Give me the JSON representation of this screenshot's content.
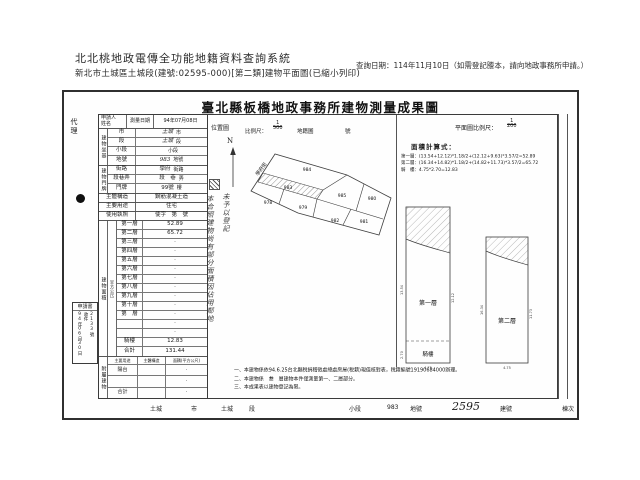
{
  "header": {
    "system_title": "北北桃地政電傳全功能地籍資料查詢系統",
    "subtitle": "新北市土城區土城段(建號:02595-000)[第二類]建物平面圖(已縮小列印)",
    "query_date": "查詢日期：114年11月10日（如需登記謄本，請向地政事務所申請。）"
  },
  "doc": {
    "title": "臺北縣板橋地政事務所建物測量成果圖",
    "agent": "代理",
    "left": {
      "applicant_l1": "申請人",
      "applicant_l2": "姓名",
      "survey_date_label": "測量日期",
      "survey_date_value": "94年07月08日",
      "site_group_label": "建物坐基",
      "site_rows": [
        {
          "label": "市",
          "value": "土城",
          "suffix": "市"
        },
        {
          "label": "段",
          "value": "土城",
          "suffix": "段"
        },
        {
          "label": "小段",
          "value": "",
          "suffix": "小段"
        },
        {
          "label": "地號",
          "value": "983",
          "suffix": "地號"
        }
      ],
      "door_group_label": "建物門牌",
      "door_rows": [
        {
          "label": "街路",
          "value": "學府",
          "suffix": "街路"
        },
        {
          "label": "段巷弄",
          "value": "段　巷",
          "suffix": "弄"
        },
        {
          "label": "門牌",
          "value": "99號",
          "suffix": "樓"
        }
      ],
      "structure_label": "主體構造",
      "structure_value": "鋼筋混凝土造",
      "usage_label": "主要用途",
      "usage_value": "住宅",
      "license_label": "使用執照",
      "license_value": "使字　第　號",
      "area_group_label": "建物面積",
      "area_unit_label": "（平方公尺）",
      "application": {
        "title": "申請書",
        "date": "94年06月30日",
        "recv": "收件",
        "no": "2133號"
      },
      "floors": [
        {
          "label": "第一層",
          "value": "52.89"
        },
        {
          "label": "第二層",
          "value": "65.72"
        },
        {
          "label": "第三層",
          "value": "·"
        },
        {
          "label": "第四層",
          "value": "·"
        },
        {
          "label": "第五層",
          "value": "·"
        },
        {
          "label": "第六層",
          "value": "·"
        },
        {
          "label": "第七層",
          "value": "·"
        },
        {
          "label": "第八層",
          "value": "·"
        },
        {
          "label": "第九層",
          "value": "·"
        },
        {
          "label": "第十層",
          "value": "·"
        },
        {
          "label": "第　層",
          "value": "·"
        },
        {
          "label": "",
          "value": "·"
        },
        {
          "label": "",
          "value": "·"
        },
        {
          "label": "騎樓",
          "value": "12.83"
        },
        {
          "label": "合計",
          "value": "131.44"
        }
      ],
      "annex_group_label": "附屬建物",
      "annex_header": {
        "usage": "主要用途",
        "structure": "主體構造",
        "area": "面積(平方公尺)"
      },
      "annex_rows": [
        {
          "usage": "陽台",
          "structure": "",
          "area": "·"
        },
        {
          "usage": "",
          "structure": "",
          "area": "·"
        },
        {
          "usage": "合計",
          "structure": "",
          "area": "·"
        }
      ]
    },
    "middle": {
      "location_label": "位置圖",
      "scale_label": "比例尺：",
      "scale_num": "1",
      "scale_den": "500",
      "cadastre_label": "地籍圖",
      "sheet_label": "號",
      "north_label": "N",
      "note_col_right": "未予以登記",
      "note_col_left": "本合照建物尚有部分面積因佔用鄰地",
      "street_label": "學府街",
      "parcels": [
        "984",
        "983",
        "978",
        "979",
        "985",
        "980",
        "981",
        "982"
      ]
    },
    "right": {
      "plan_scale_label": "平面圖比例尺：",
      "plan_num": "1",
      "plan_den": "200",
      "calc_title": "面積計算式：",
      "calc_lines": [
        "第一層：(13.54+12.12)*1.18/2+(12.12+9.63)*3.57/2=52.89",
        "第二層：(16.34+14.82)*1.18/2+(14.82+11.73)*3.57/2=65.72",
        "騎　樓：4.75*2.70=12.83"
      ],
      "plan1_label": "第一層",
      "porch_label": "騎樓",
      "plan2_label": "第二層",
      "dims": {
        "p1_left": "13.54",
        "p1_right": "12.12",
        "p1_porch": "2.70",
        "p1_bottom": "4.75",
        "p2_left": "16.34",
        "p2_right": "11.73",
        "p2_bottom": "4.75"
      }
    },
    "notes": [
      "一、本建物係依94.6.25台北縣稅捐稽徵處總處房屋(稅籍)現值核對表，稅籍編號19190684000辦理。",
      "二、本建物係　叁　層建物本件僅測量第一、二層部分。",
      "三、本成果表以建物登記為限。"
    ],
    "bottom": {
      "city": "土城",
      "city_u": "市",
      "section": "土城",
      "section_u": "段",
      "subsection_u": "小段",
      "parcel_no": "983",
      "parcel_u": "地號",
      "building_no": "2595",
      "building_u": "建號",
      "block_u": "棟次"
    }
  }
}
